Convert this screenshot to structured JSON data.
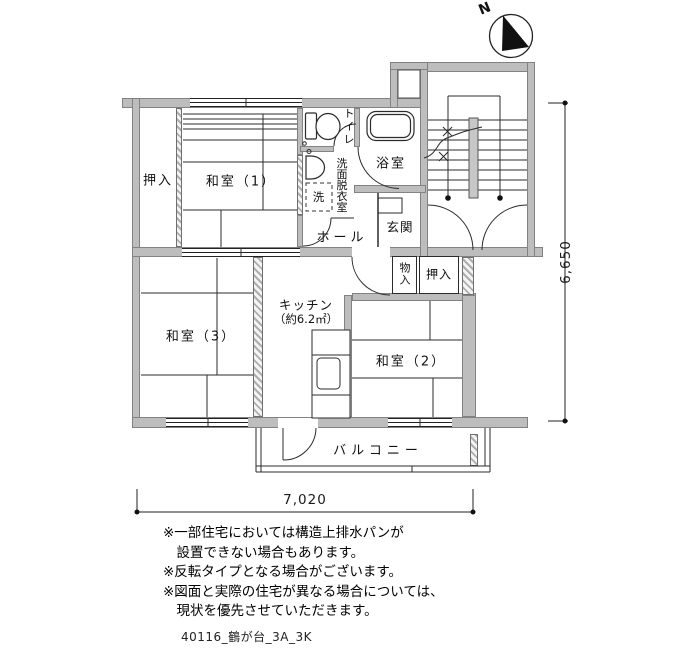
{
  "compass": {
    "n": "N"
  },
  "rooms": {
    "oshiire1": "押入",
    "washitsu1": "和室（1）",
    "toilet": "トイレ",
    "senmen": "洗面脱衣室",
    "laundry": "洗",
    "bath": "浴室",
    "hall": "ホール",
    "genkan": "玄関",
    "monoire": "物入",
    "oshiire2": "押入",
    "washitsu2": "和室（2）",
    "washitsu3": "和室（3）",
    "kitchen_name": "キッチン",
    "kitchen_area": "（約6.2㎡）",
    "balcony": "バルコニー"
  },
  "dimensions": {
    "width": "7,020",
    "height": "6,650"
  },
  "notes": [
    "※一部住宅においては構造上排水パンが",
    "　設置できない場合もあります。",
    "※反転タイプとなる場合がございます。",
    "※図面と実際の住宅が異なる場合については、",
    "　現状を優先させていただきます。"
  ],
  "footer": {
    "filename": "40116_鶴が台_3A_3K"
  }
}
